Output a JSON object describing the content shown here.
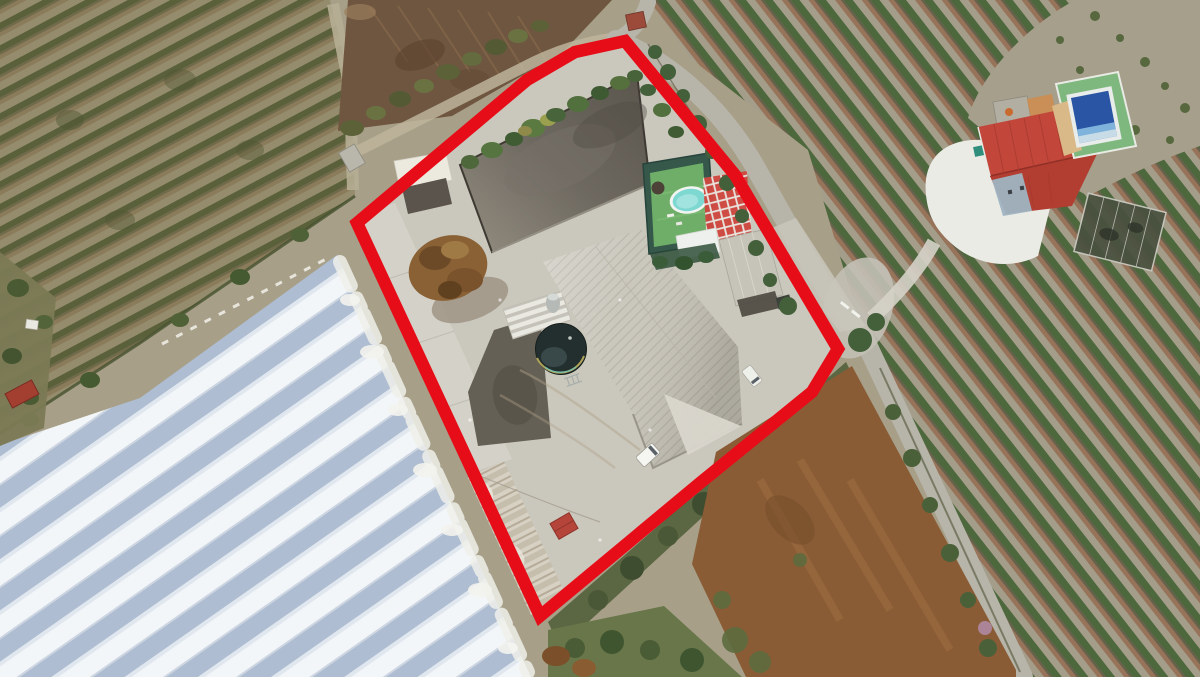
{
  "scene": {
    "type": "aerial-drone-photo",
    "description": "Aerial drone photograph of a rural farm compound outlined with a thick red property boundary, surrounded by orchard rows, a large white plastic greenhouse, dirt fields, country roads and a neighbouring house with a blue pool",
    "boundary": {
      "color": "#e70d18",
      "stroke_px": 12.5,
      "points": "357,223 527,80 575,52 625,41 735,175 838,349 812,392 700,483 540,616"
    },
    "colors": {
      "terrain_tan": "#a79f88",
      "orchard_left_soil": "#948c6c",
      "orchard_left_trees": "#59603a",
      "orchard_right_soil": "#a49d8a",
      "orchard_right_trees": "#4d683c",
      "ploughed_brown": "#6f5640",
      "greenhouse_white": "#f3f6f8",
      "greenhouse_blue": "#aebdd1",
      "compound_concrete": "#cac7bc",
      "reservoir_dark": "#5a554c",
      "reservoir_light": "#948e81",
      "warehouse_roof": "#d4d2c8",
      "main_roof": "#c8c5ba",
      "tank_dark": "#232f2e",
      "pool_turf": "#6fae68",
      "pool_water": "#7ed8d2",
      "checker_red": "#cf4840",
      "house_roof_red": "#c2463a",
      "house_pool_blue": "#2a55a5",
      "road_gray": "#b7b4a9",
      "dirt_brown": "#8a5c36",
      "scrub_green": "#53603c",
      "driveway_white": "#ebebe6",
      "compost_brown": "#8a6134"
    },
    "landmarks": [
      {
        "name": "outlined-property",
        "description": "farm compound outlined in red"
      },
      {
        "name": "dark-reservoir",
        "description": "dark walled reservoir yard at top of compound"
      },
      {
        "name": "main-warehouse",
        "description": "large grey ribbed warehouse roof in centre"
      },
      {
        "name": "side-warehouse",
        "description": "long narrow warehouse along left boundary"
      },
      {
        "name": "circular-water-tank",
        "description": "open circular water tank beside warehouse"
      },
      {
        "name": "pool-enclosure",
        "description": "oval pool on green turf with red-white tiled terrace"
      },
      {
        "name": "carport",
        "description": "small grey carport roof near entrance"
      },
      {
        "name": "compost-pile",
        "description": "brown compost pile near left sheds"
      },
      {
        "name": "greenhouses",
        "description": "large white plastic greenhouses, bottom left"
      },
      {
        "name": "left-orchard",
        "description": "dry orchard rows, top left"
      },
      {
        "name": "right-orchard",
        "description": "orchard rows with green trees, right side"
      },
      {
        "name": "ploughed-field",
        "description": "brown ploughed field, top centre"
      },
      {
        "name": "neighbour-house",
        "description": "house with red roof, blue pool and white driveway, top right"
      },
      {
        "name": "dirt-road",
        "description": "country road running down the right side"
      },
      {
        "name": "brown-field",
        "description": "bare brown field, bottom centre-right"
      },
      {
        "name": "white-van",
        "description": "white van parked at warehouse corner"
      },
      {
        "name": "white-car",
        "description": "white car parked near entrance gate"
      }
    ]
  }
}
